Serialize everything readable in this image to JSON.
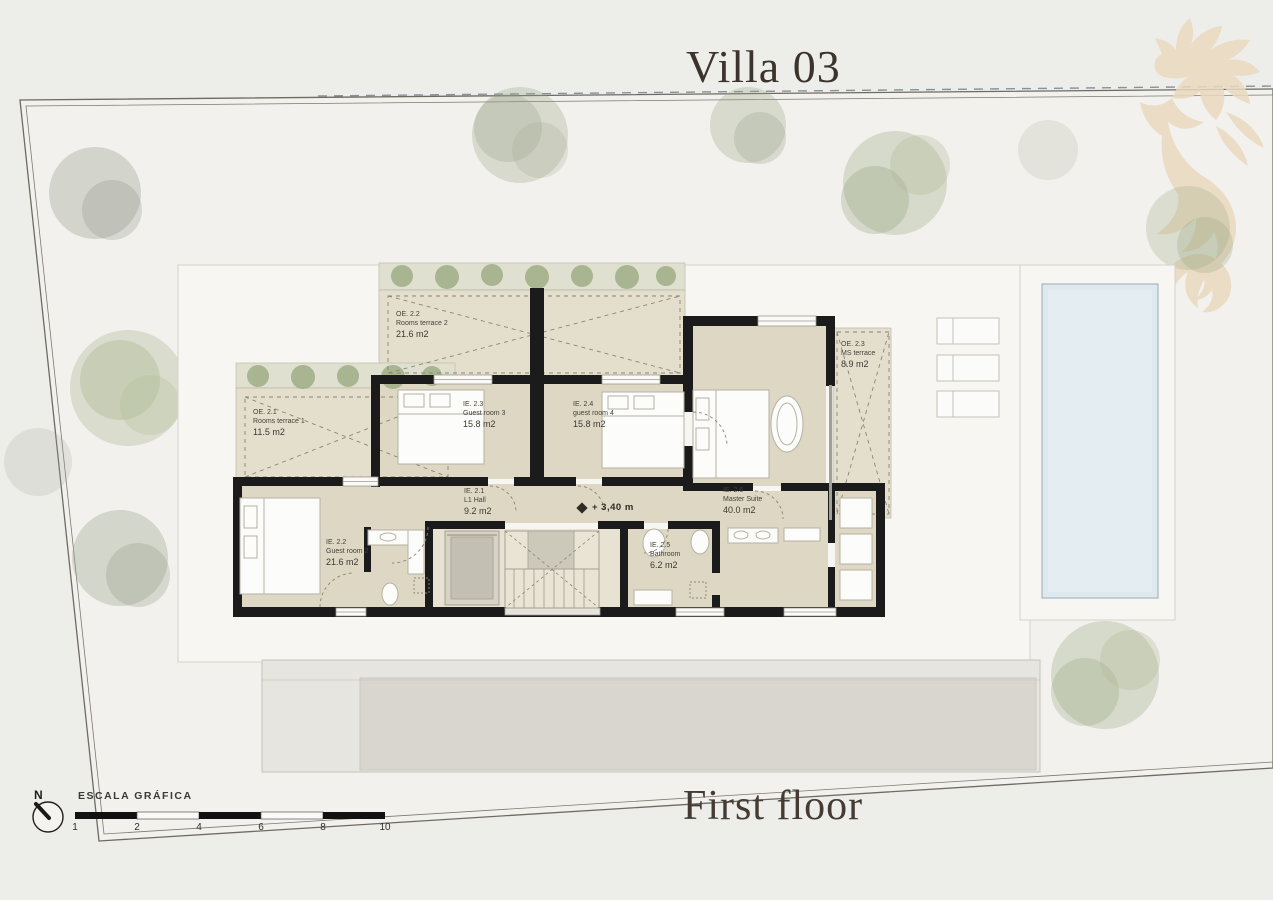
{
  "header": {
    "title": "Villa 03"
  },
  "footer": {
    "floor_label": "First floor"
  },
  "icons": {
    "logo": "seahorse-watermark",
    "compass": "north-arrow",
    "level_symbol": "diamond"
  },
  "compass": {
    "label": "N"
  },
  "scale_bar": {
    "label": "ESCALA GRÁFICA",
    "ticks": [
      "1",
      "2",
      "4",
      "6",
      "8",
      "10"
    ]
  },
  "level_marker": {
    "symbol": "◆",
    "value": "+ 3,40 m"
  },
  "rooms": [
    {
      "code": "OE. 2.2",
      "name": "Rooms terrace 2",
      "area": "21.6 m2"
    },
    {
      "code": "OE. 2.1",
      "name": "Rooms terrace 1",
      "area": "11.5 m2"
    },
    {
      "code": "OE. 2.3",
      "name": "MS terrace",
      "area": "8.9 m2"
    },
    {
      "code": "IE. 2.3",
      "name": "Guest room 3",
      "area": "15.8 m2"
    },
    {
      "code": "IE. 2.4",
      "name": "guest room 4",
      "area": "15.8 m2"
    },
    {
      "code": "IE. 2.1",
      "name": "L1 Hall",
      "area": "9.2 m2"
    },
    {
      "code": "IE. 2.6",
      "name": "Master Suite",
      "area": "40.0 m2"
    },
    {
      "code": "IE. 2.2",
      "name": "Guest room 2",
      "area": "21.6 m2"
    },
    {
      "code": "IE. 2.5",
      "name": "Bathroom",
      "area": "6.2 m2"
    }
  ],
  "colors": {
    "background": "#edeeea",
    "site_fill": "#f2f1ed",
    "footprint_white": "#f7f6f2",
    "floor_beige": "#ddd7c4",
    "terrace_beige": "#e4decd",
    "wall_black": "#1b1b1b",
    "pool_water": "#dde9ef",
    "driveway_gray": "#d9d6d0",
    "tree_green": "#a9b296",
    "seahorse_beige": "#ead9bf",
    "title_brown": "#3c332d"
  }
}
